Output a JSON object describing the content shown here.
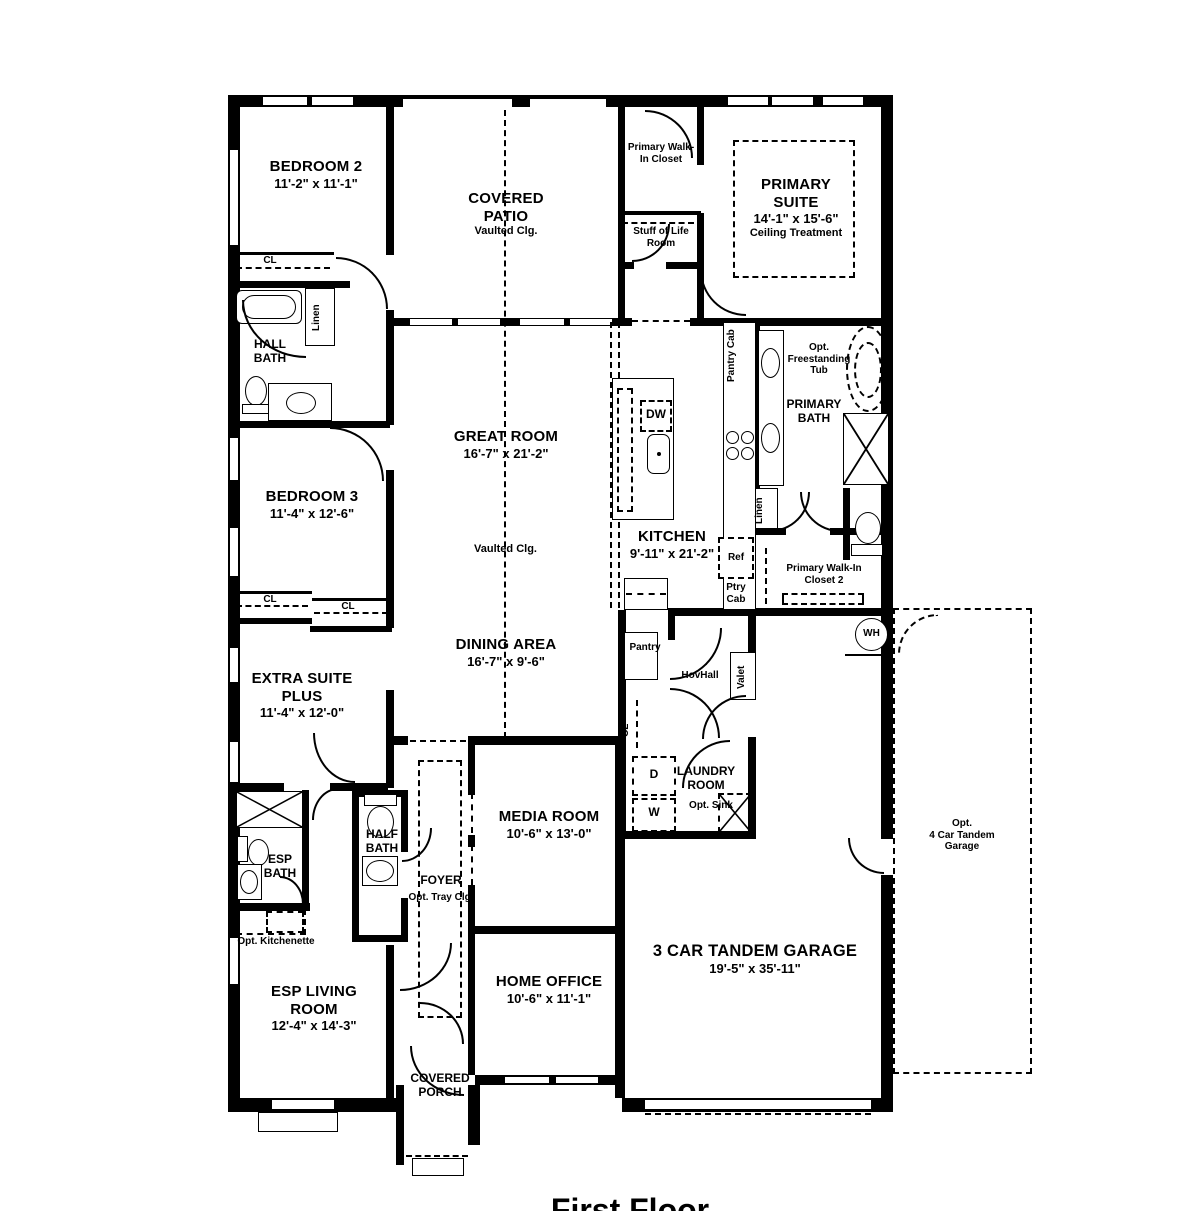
{
  "title": "First Floor",
  "rooms": {
    "bedroom2": {
      "name": "BEDROOM 2",
      "dims": "11'-2\" x 11'-1\""
    },
    "covered_patio": {
      "name": "COVERED PATIO",
      "sub": "Vaulted Clg."
    },
    "primary_wic": {
      "name": "Primary Walk-In Closet"
    },
    "stuff_of_life": {
      "name": "Stuff of Life Room"
    },
    "primary_suite": {
      "name": "PRIMARY SUITE",
      "dims": "14'-1\" x 15'-6\"",
      "sub": "Ceiling Treatment"
    },
    "hall_bath": {
      "name": "HALL BATH"
    },
    "great_room": {
      "name": "GREAT ROOM",
      "dims": "16'-7\" x 21'-2\"",
      "sub": "Vaulted Clg."
    },
    "kitchen": {
      "name": "KITCHEN",
      "dims": "9'-11\" x 21'-2\""
    },
    "primary_bath": {
      "name": "PRIMARY BATH"
    },
    "opt_tub": {
      "name": "Opt. Freestanding Tub"
    },
    "bedroom3": {
      "name": "BEDROOM 3",
      "dims": "11'-4\" x 12'-6\""
    },
    "primary_wic2": {
      "name": "Primary Walk-In Closet 2"
    },
    "extra_suite_plus": {
      "name": "EXTRA SUITE PLUS",
      "dims": "11'-4\" x 12'-0\""
    },
    "dining_area": {
      "name": "DINING AREA",
      "dims": "16'-7\" x 9'-6\""
    },
    "pantry": {
      "name": "Pantry"
    },
    "hovhall": {
      "name": "HovHall"
    },
    "valet": {
      "name": "Valet"
    },
    "laundry": {
      "name": "LAUNDRY ROOM",
      "sub": "Opt. Sink"
    },
    "media_room": {
      "name": "MEDIA ROOM",
      "dims": "10'-6\" x 13'-0\""
    },
    "half_bath": {
      "name": "HALF BATH"
    },
    "esp_bath": {
      "name": "ESP BATH"
    },
    "opt_kitchenette": {
      "name": "Opt. Kitchenette"
    },
    "foyer": {
      "name": "FOYER",
      "sub": "Opt. Tray Clg."
    },
    "esp_living": {
      "name": "ESP LIVING ROOM",
      "dims": "12'-4\" x 14'-3\""
    },
    "home_office": {
      "name": "HOME OFFICE",
      "dims": "10'-6\" x 11'-1\""
    },
    "covered_porch": {
      "name": "COVERED PORCH"
    },
    "garage": {
      "name": "3 CAR TANDEM GARAGE",
      "dims": "19'-5\" x 35'-11\""
    },
    "opt_garage": {
      "name": "Opt.",
      "sub": "4 Car Tandem Garage"
    }
  },
  "labels": {
    "cl": "CL",
    "linen": "Linen",
    "pantry_cab": "Pantry Cab",
    "ptry_cab": "Ptry Cab",
    "ref": "Ref",
    "dw": "DW",
    "wh": "WH",
    "d": "D",
    "w": "W"
  }
}
